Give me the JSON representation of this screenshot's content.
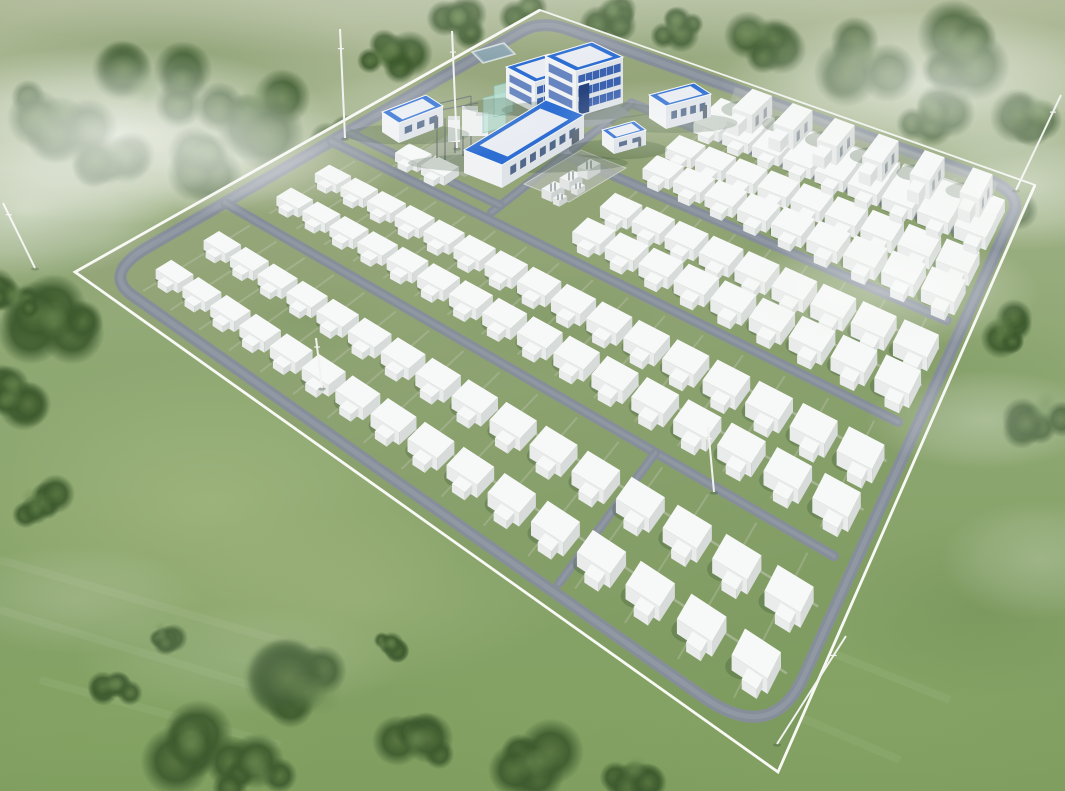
{
  "scene": {
    "description": "aerial-3d-rendering-of-battery-energy-storage-power-station",
    "canvas": {
      "width": 1065,
      "height": 791
    },
    "palette": {
      "field_top": "#aeb997",
      "field_mid": "#8fa873",
      "field_low": "#7f9e5f",
      "site_far": "#9aa87f",
      "site_near": "#7d9b5f",
      "road": "#868e9a",
      "road_sheen": "#a4acb6",
      "walkway": "#c6cbbb",
      "pad": "#b4bab0",
      "fence": "#f1f3ee",
      "fence_bright": "#f8f9f5",
      "box_top": "#f7f9f8",
      "box_side": "#e9eceb",
      "box_end": "#d7dbd9",
      "shadow": "#2f4a2c",
      "roof_blue": "#2e6ed2",
      "roof_inner": "#e9edf3",
      "roof_edge": "#f6f8fb",
      "wall_light": "#f0f2f4",
      "wall_shade": "#dee3e8",
      "glass_band": "#2c57a9",
      "window_dark": "#51688b",
      "door_dark": "#5d6a75",
      "entrance_glass": "#27447e",
      "teal_screen": "#b8e2d8",
      "teal_edge": "#7fbcae",
      "equip_gray": "#6b7277",
      "vent_gray": "#9aa3a9",
      "pond_fill": "#9db3bc",
      "pond_inner": "#8aa4ae",
      "pond_edge": "#d4dde0",
      "court_fill": "#9aa2a6",
      "tree_core": "#57743f",
      "tree_dark": "#3d5a2e",
      "mast": "#f2f3f0"
    },
    "site": {
      "quad": {
        "left": [
          75,
          272
        ],
        "top": [
          540,
          10
        ],
        "right": [
          1035,
          185
        ],
        "bottom": [
          778,
          772
        ]
      },
      "road_corners": [
        [
          0.018,
          0.03
        ],
        [
          0.965,
          0.03
        ],
        [
          0.968,
          0.988
        ],
        [
          0.015,
          0.988
        ]
      ],
      "perimeter_road_width": 12
    },
    "roads_internal": [
      {
        "name": "road-v1",
        "axis": "v",
        "pos": 0.205,
        "a": 0.03,
        "b": 0.968,
        "w": 10
      },
      {
        "name": "road-v2",
        "axis": "v",
        "pos": 0.405,
        "a": 0.03,
        "b": 0.968,
        "w": 10
      },
      {
        "name": "road-v3",
        "axis": "v",
        "pos": 0.605,
        "a": 0.35,
        "b": 0.968,
        "w": 10
      },
      {
        "name": "road-v4",
        "axis": "v",
        "pos": 0.805,
        "a": 0.35,
        "b": 0.968,
        "w": 10
      },
      {
        "name": "road-u-buildings",
        "axis": "u",
        "pos": 0.35,
        "a": 0.42,
        "b": 0.805,
        "w": 9
      },
      {
        "name": "road-v-substation",
        "axis": "v",
        "pos": 0.44,
        "a": 0.03,
        "b": 0.35,
        "w": 9
      },
      {
        "name": "road-u-connector",
        "axis": "u",
        "pos": 0.76,
        "a": 0.025,
        "b": 0.205,
        "w": 9
      }
    ],
    "container_field": {
      "row_t_start": 0.1,
      "row_t_step": 0.0563,
      "row_count": 16,
      "unit": {
        "w_min": 15,
        "w_max": 27,
        "depth_ratio": 1.45,
        "height_ratio": 0.52,
        "s_scale_a": 1.15,
        "s_scale_b": 0.3
      },
      "bands": [
        {
          "name": "band-1",
          "cols": [
            0.075,
            0.148
          ],
          "rows": [
            0,
            15
          ]
        },
        {
          "name": "band-2",
          "cols": [
            0.272,
            0.345
          ],
          "rows": [
            0,
            15
          ]
        },
        {
          "name": "band-3a",
          "cols": [
            0.46
          ],
          "rows": [
            1,
            2
          ]
        },
        {
          "name": "band-3",
          "cols": [
            0.475,
            0.548
          ],
          "rows": [
            7,
            15
          ]
        },
        {
          "name": "band-4",
          "cols": [
            0.672,
            0.745
          ],
          "rows": [
            7,
            15
          ]
        },
        {
          "name": "band-5",
          "cols": [
            0.843,
            0.895
          ],
          "rows": [
            7,
            15
          ]
        }
      ]
    },
    "pcs_row": {
      "s": 0.945,
      "t_values": [
        0.52,
        0.6,
        0.68,
        0.76,
        0.84,
        0.92
      ],
      "w": 28,
      "depth": 21,
      "height": 19,
      "strip_t": [
        0.48,
        0.95
      ]
    },
    "buildings": [
      {
        "name": "building-admin-wing",
        "top": [
          [
            506,
            67
          ],
          [
            549,
            54
          ],
          [
            578,
            69
          ],
          [
            535,
            82
          ]
        ],
        "h": 31,
        "front_bands": [
          [
            0.18,
            0.42
          ],
          [
            0.56,
            0.8
          ]
        ],
        "side_bands": [
          [
            0.18,
            0.42
          ],
          [
            0.56,
            0.8
          ]
        ]
      },
      {
        "name": "building-admin",
        "top": [
          [
            545,
            56
          ],
          [
            592,
            42
          ],
          [
            623,
            57
          ],
          [
            576,
            71
          ]
        ],
        "h": 46,
        "front_bands": [
          [
            0.12,
            0.3
          ],
          [
            0.4,
            0.58
          ],
          [
            0.68,
            0.86
          ]
        ],
        "side_bands": [
          [
            0.12,
            0.3
          ],
          [
            0.4,
            0.58
          ],
          [
            0.68,
            0.86
          ]
        ],
        "entrance": {
          "u0": 0.06,
          "u1": 0.28,
          "y0": 0.34,
          "y1": 0.97
        }
      },
      {
        "name": "building-hall",
        "top": [
          [
            464,
            150
          ],
          [
            546,
            100
          ],
          [
            584,
            115
          ],
          [
            502,
            165
          ]
        ],
        "h": 23,
        "front_windows": {
          "n": 7,
          "y0": 0.3,
          "y1": 0.66
        },
        "door_u": 0.85
      },
      {
        "name": "building-aux-west",
        "top": [
          [
            382,
            112
          ],
          [
            426,
            95
          ],
          [
            443,
            106
          ],
          [
            399,
            123
          ]
        ],
        "h": 20,
        "front_windows": {
          "n": 3,
          "y0": 0.32,
          "y1": 0.66
        },
        "door_u": 0.8
      },
      {
        "name": "building-aux-east",
        "top": [
          [
            649,
            95
          ],
          [
            694,
            83
          ],
          [
            711,
            94
          ],
          [
            666,
            106
          ]
        ],
        "h": 23,
        "front_windows": {
          "n": 4,
          "y0": 0.3,
          "y1": 0.64
        },
        "door_u": 0.82
      },
      {
        "name": "building-kiosk",
        "top": [
          [
            602,
            130
          ],
          [
            634,
            121
          ],
          [
            646,
            130
          ],
          [
            614,
            139
          ]
        ],
        "h": 15,
        "front_windows": {
          "n": 2,
          "y0": 0.32,
          "y1": 0.62
        },
        "door_u": 0.76
      }
    ],
    "substation": {
      "pad": [
        [
          413,
          156
        ],
        [
          507,
          99
        ],
        [
          559,
          120
        ],
        [
          465,
          177
        ]
      ],
      "screens": [
        [
          [
            483,
            98
          ],
          [
            506,
            92
          ],
          [
            506,
            127
          ],
          [
            483,
            133
          ]
        ],
        [
          [
            494,
            86
          ],
          [
            513,
            81
          ],
          [
            513,
            112
          ],
          [
            494,
            117
          ]
        ]
      ],
      "white_boxes": [
        [
          462,
          106,
          16,
          30
        ],
        [
          448,
          116,
          12,
          26
        ],
        [
          476,
          112,
          12,
          24
        ]
      ],
      "gantry_lines": [
        [
          437,
          158,
          437,
          104
        ],
        [
          455,
          153,
          455,
          100
        ],
        [
          471,
          149,
          471,
          96
        ],
        [
          437,
          104,
          471,
          96
        ],
        [
          430,
          112,
          478,
          103
        ],
        [
          445,
          160,
          445,
          118
        ],
        [
          463,
          156,
          463,
          114
        ]
      ],
      "pond": [
        [
          472,
          52
        ],
        [
          504,
          43
        ],
        [
          515,
          54
        ],
        [
          483,
          63
        ]
      ],
      "courtyard": [
        [
          570,
          115
        ],
        [
          615,
          102
        ],
        [
          632,
          115
        ],
        [
          587,
          128
        ]
      ],
      "transformer_pad": [
        [
          524,
          184
        ],
        [
          581,
          150
        ],
        [
          626,
          168
        ],
        [
          569,
          202
        ]
      ],
      "transformers": [
        {
          "c": [
            553,
            187
          ],
          "w": 15,
          "d": 11,
          "h": 9
        },
        {
          "c": [
            571,
            176
          ],
          "w": 15,
          "d": 11,
          "h": 9
        },
        {
          "c": [
            589,
            165
          ],
          "w": 15,
          "d": 11,
          "h": 9
        },
        {
          "c": [
            560,
            197
          ],
          "w": 9,
          "d": 7,
          "h": 6
        },
        {
          "c": [
            578,
            186
          ],
          "w": 9,
          "d": 7,
          "h": 6
        }
      ],
      "axes": {
        "u": [
          0.854,
          -0.52
        ],
        "v": [
          0.92,
          0.39
        ]
      }
    },
    "masts": [
      {
        "name": "lightning-mast-west",
        "base": [
          35,
          268
        ],
        "tip": [
          3,
          203
        ]
      },
      {
        "name": "lightning-mast-north1",
        "base": [
          345,
          138
        ],
        "tip": [
          340,
          29
        ]
      },
      {
        "name": "lightning-mast-north2",
        "base": [
          457,
          148
        ],
        "tip": [
          452,
          31
        ]
      },
      {
        "name": "lightning-mast-east",
        "base": [
          1016,
          190
        ],
        "tip": [
          1061,
          95
        ]
      },
      {
        "name": "lightning-mast-south",
        "base": [
          777,
          744
        ],
        "tip": [
          846,
          636
        ]
      },
      {
        "name": "lightning-mast-field1",
        "base": [
          322,
          388
        ],
        "tip": [
          316,
          338
        ]
      },
      {
        "name": "lightning-mast-field2",
        "base": [
          714,
          492
        ],
        "tip": [
          708,
          427
        ]
      }
    ],
    "trees": [
      [
        60,
        118,
        55,
        0
      ],
      [
        150,
        92,
        62,
        0
      ],
      [
        250,
        115,
        62,
        0
      ],
      [
        335,
        148,
        48,
        0
      ],
      [
        200,
        165,
        50,
        0
      ],
      [
        115,
        160,
        45,
        0
      ],
      [
        390,
        58,
        38,
        1
      ],
      [
        455,
        22,
        32,
        1
      ],
      [
        525,
        12,
        26,
        1
      ],
      [
        610,
        15,
        30,
        1
      ],
      [
        678,
        28,
        30,
        1
      ],
      [
        755,
        42,
        48,
        1
      ],
      [
        860,
        60,
        55,
        1
      ],
      [
        960,
        55,
        58,
        1
      ],
      [
        1040,
        115,
        48,
        1
      ],
      [
        935,
        115,
        40,
        1
      ],
      [
        995,
        225,
        48,
        1
      ],
      [
        1045,
        415,
        42,
        1
      ],
      [
        1000,
        330,
        35,
        1
      ],
      [
        58,
        325,
        52,
        0
      ],
      [
        20,
        395,
        40,
        0
      ],
      [
        38,
        505,
        34,
        1
      ],
      [
        12,
        300,
        35,
        0
      ],
      [
        190,
        750,
        58,
        0
      ],
      [
        320,
        695,
        65,
        0
      ],
      [
        255,
        775,
        45,
        0
      ],
      [
        420,
        740,
        40,
        0
      ],
      [
        540,
        762,
        52,
        0
      ],
      [
        635,
        778,
        38,
        0
      ],
      [
        115,
        690,
        28,
        1
      ],
      [
        165,
        635,
        22,
        1
      ],
      [
        388,
        645,
        20,
        1
      ]
    ],
    "fog": [
      [
        115,
        135,
        230,
        90,
        0.8
      ],
      [
        25,
        210,
        150,
        70,
        0.55
      ],
      [
        250,
        160,
        160,
        55,
        0.38
      ],
      [
        420,
        115,
        130,
        45,
        0.22
      ],
      [
        930,
        85,
        210,
        75,
        0.65
      ],
      [
        1025,
        185,
        130,
        65,
        0.5
      ],
      [
        880,
        290,
        160,
        60,
        0.42
      ],
      [
        985,
        420,
        120,
        50,
        0.3
      ],
      [
        1040,
        560,
        100,
        60,
        0.22
      ],
      [
        75,
        600,
        130,
        55,
        0.16
      ],
      [
        240,
        660,
        170,
        55,
        0.14
      ],
      [
        660,
        120,
        110,
        40,
        0.25
      ],
      [
        532,
        -10,
        620,
        70,
        0.25
      ]
    ],
    "terrain_patches": [
      [
        210,
        505,
        270,
        150,
        "light",
        0.4
      ],
      [
        120,
        725,
        210,
        95,
        "mid",
        0.45
      ],
      [
        360,
        600,
        200,
        90,
        "light",
        0.3
      ],
      [
        850,
        700,
        270,
        120,
        "mid",
        0.4
      ],
      [
        980,
        610,
        160,
        90,
        "dark",
        0.3
      ],
      [
        560,
        700,
        210,
        85,
        "mid",
        0.3
      ],
      [
        330,
        240,
        210,
        95,
        "dark",
        0.22
      ],
      [
        70,
        250,
        110,
        65,
        "dark",
        0.25
      ],
      [
        900,
        380,
        190,
        95,
        "dark",
        0.25
      ],
      [
        650,
        50,
        250,
        70,
        "dark",
        0.3
      ],
      [
        180,
        60,
        200,
        70,
        "dark",
        0.35
      ]
    ],
    "mow_lines": [
      [
        0,
        560,
        330,
        655
      ],
      [
        0,
        610,
        300,
        700
      ],
      [
        40,
        680,
        280,
        745
      ],
      [
        620,
        640,
        900,
        760
      ],
      [
        700,
        600,
        950,
        700
      ]
    ]
  }
}
